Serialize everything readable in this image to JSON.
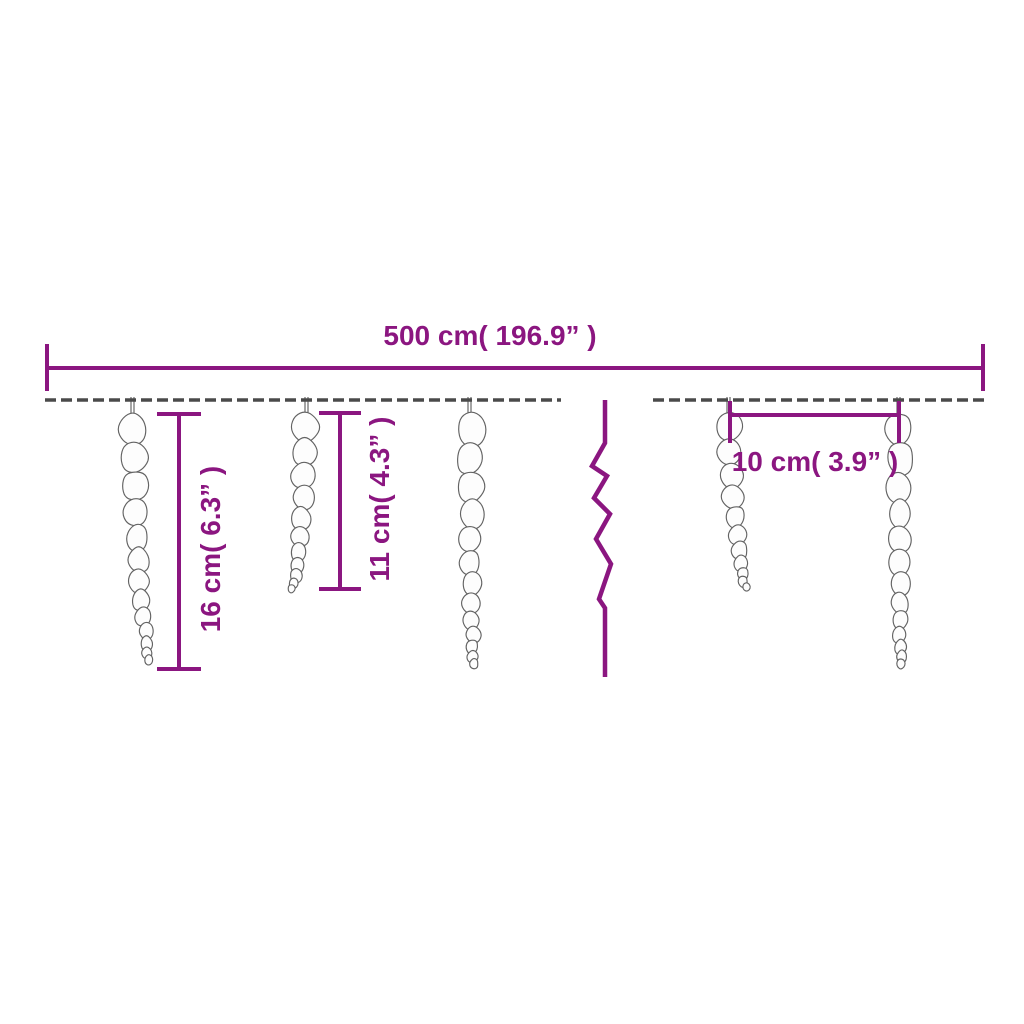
{
  "diagram": {
    "background_color": "#ffffff",
    "accent_color": "#8b1680",
    "wire_color": "#4a4a4a",
    "icicle_outline_color": "#636363",
    "icicle_fill_color": "#fdfdfd",
    "scene": {
      "visible_icicles": 5,
      "wire_segments": 2,
      "break_symbol": "zigzag"
    },
    "dimensions": [
      {
        "id": "total-width",
        "label": "500 cm( 196.9”  )",
        "cm": 500,
        "inches": 196.9,
        "orientation": "horizontal"
      },
      {
        "id": "long-icicle-length",
        "label": "16 cm( 6.3”  )",
        "cm": 16,
        "inches": 6.3,
        "orientation": "vertical"
      },
      {
        "id": "short-icicle-length",
        "label": "11 cm( 4.3”  )",
        "cm": 11,
        "inches": 4.3,
        "orientation": "vertical"
      },
      {
        "id": "icicle-spacing",
        "label": "10 cm( 3.9”  )",
        "cm": 10,
        "inches": 3.9,
        "orientation": "horizontal"
      }
    ]
  }
}
